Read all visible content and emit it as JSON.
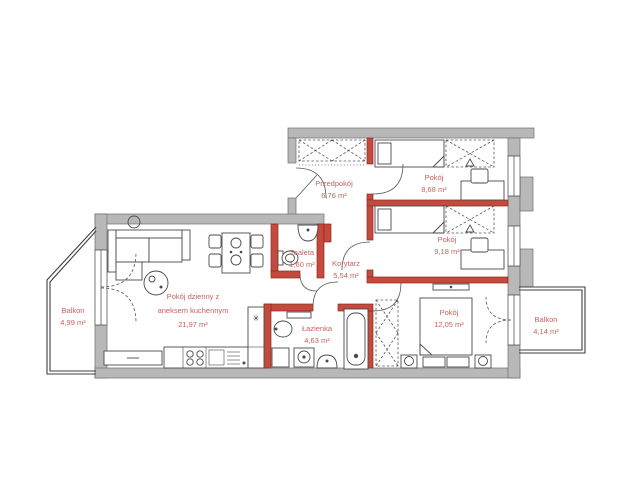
{
  "colors": {
    "background": "#ffffff",
    "wall_fill": "#b8b8b8",
    "wall_stroke": "#6e6e6e",
    "partition_fill": "#c24b3e",
    "partition_stroke": "#93291e",
    "label_color": "#c4635a",
    "line_color": "#4a4a4a"
  },
  "rooms": [
    {
      "id": "balcony-left",
      "name": "Balkon",
      "area": "4,99 m²"
    },
    {
      "id": "living-room",
      "name": "Pokój dzienny z aneksem kuchennym",
      "name_lines": [
        "Pokój dzienny z",
        "aneksem kuchennym"
      ],
      "area": "21,97 m²"
    },
    {
      "id": "toilet",
      "name": "Toaleta",
      "area": "1,60 m²"
    },
    {
      "id": "corridor",
      "name": "Korytarz",
      "area": "5,54 m²"
    },
    {
      "id": "bathroom",
      "name": "Łazienka",
      "area": "4,63 m²"
    },
    {
      "id": "entrance-hall",
      "name": "Przedpokój",
      "area": "6,76 m²"
    },
    {
      "id": "room-1",
      "name": "Pokój",
      "area": "8,68 m²"
    },
    {
      "id": "room-2",
      "name": "Pokój",
      "area": "9,18 m²"
    },
    {
      "id": "bedroom",
      "name": "Pokój",
      "area": "12,05 m²"
    },
    {
      "id": "balcony-right",
      "name": "Balkon",
      "area": "4,14 m²"
    }
  ],
  "icons": {
    "freezer_star": "✳"
  }
}
